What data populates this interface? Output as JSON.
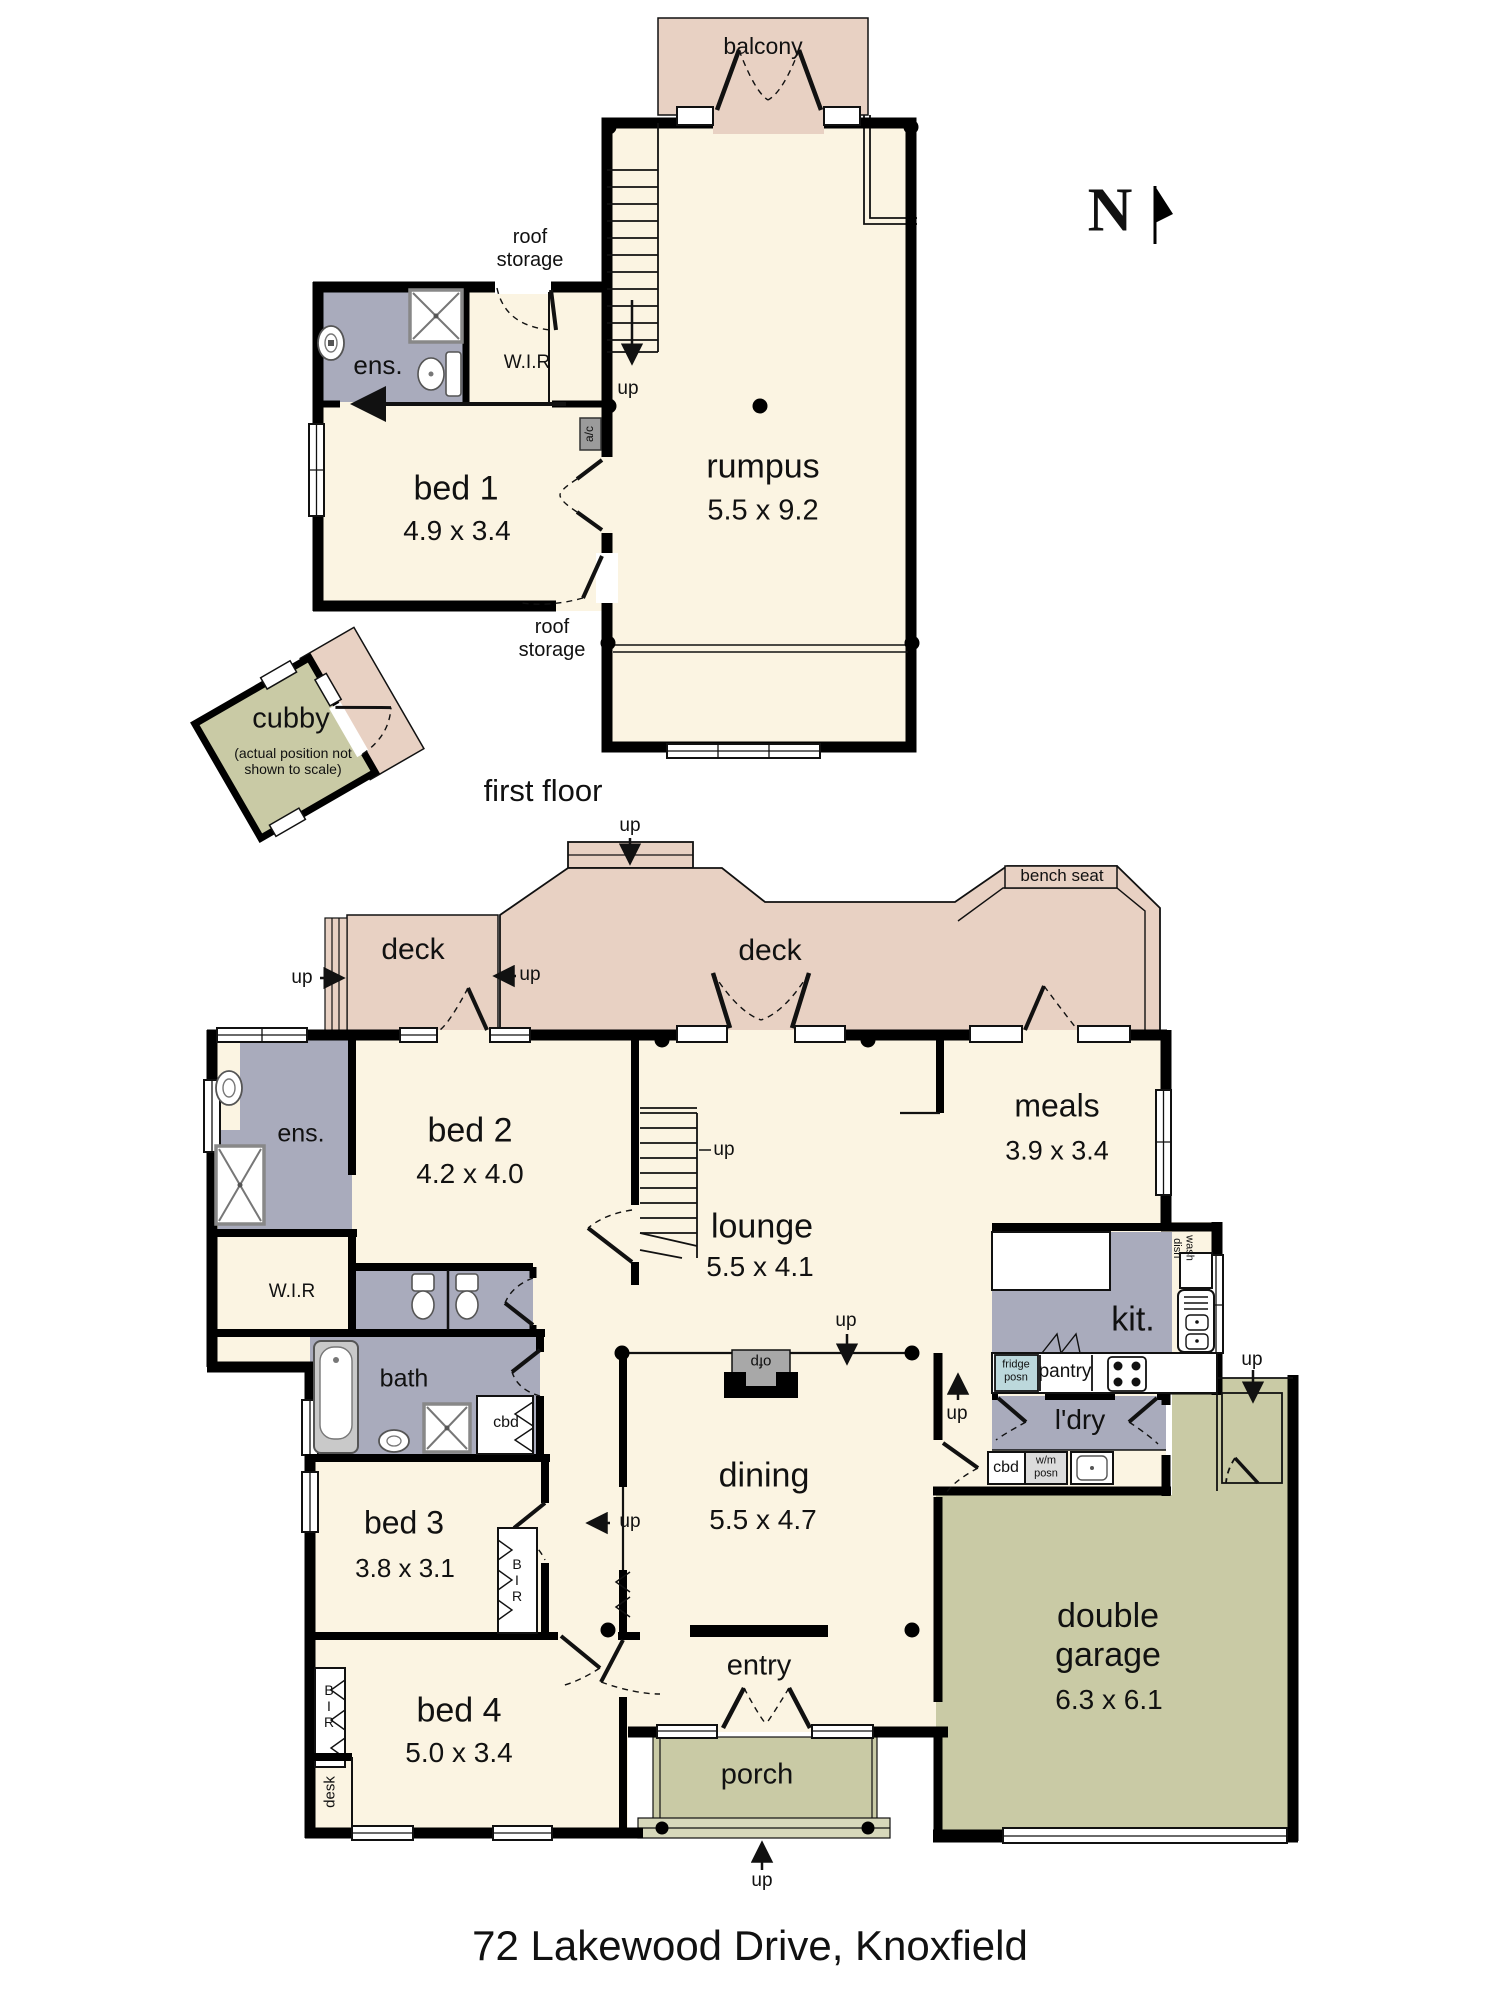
{
  "address": "72 Lakewood Drive, Knoxfield",
  "captions": {
    "first_floor": "first floor",
    "compass_north": "N"
  },
  "labels": {
    "up": "up",
    "deck": "deck",
    "balcony": "balcony",
    "bench_seat": "bench seat",
    "roof_storage": "roof\nstorage",
    "ens": "ens.",
    "wir": "W.I.R",
    "ac": "a/c",
    "bir": "B\nI\nR",
    "desk": "desk",
    "cbd": "cbd",
    "bath": "bath",
    "ofp": "ofp",
    "entry": "entry",
    "porch": "porch",
    "pantry": "pantry",
    "fridge_posn": "fridge\nposn",
    "wm_posn": "w/m\nposn",
    "dish_wash": "dish\nwash",
    "ldry": "l'dry",
    "kit": "kit.",
    "cubby": "cubby",
    "cubby_note": "(actual position not\nshown to scale)"
  },
  "rooms": {
    "rumpus": {
      "name": "rumpus",
      "dims": "5.5 x 9.2"
    },
    "bed1": {
      "name": "bed 1",
      "dims": "4.9 x 3.4"
    },
    "bed2": {
      "name": "bed 2",
      "dims": "4.2 x 4.0"
    },
    "bed3": {
      "name": "bed 3",
      "dims": "3.8 x 3.1"
    },
    "bed4": {
      "name": "bed 4",
      "dims": "5.0 x 3.4"
    },
    "lounge": {
      "name": "lounge",
      "dims": "5.5 x 4.1"
    },
    "meals": {
      "name": "meals",
      "dims": "3.9 x 3.4"
    },
    "dining": {
      "name": "dining",
      "dims": "5.5 x 4.7"
    },
    "garage": {
      "name": "double\ngarage",
      "dims": "6.3 x 6.1"
    }
  },
  "colors": {
    "floor": "#fbf4e2",
    "deck": "#e8d1c3",
    "wet_area": "#a9abbc",
    "outdoor": "#c9caa5",
    "porch_step": "#d7d8bb",
    "fridge": "#bcd8dc",
    "wall": "#000000"
  }
}
